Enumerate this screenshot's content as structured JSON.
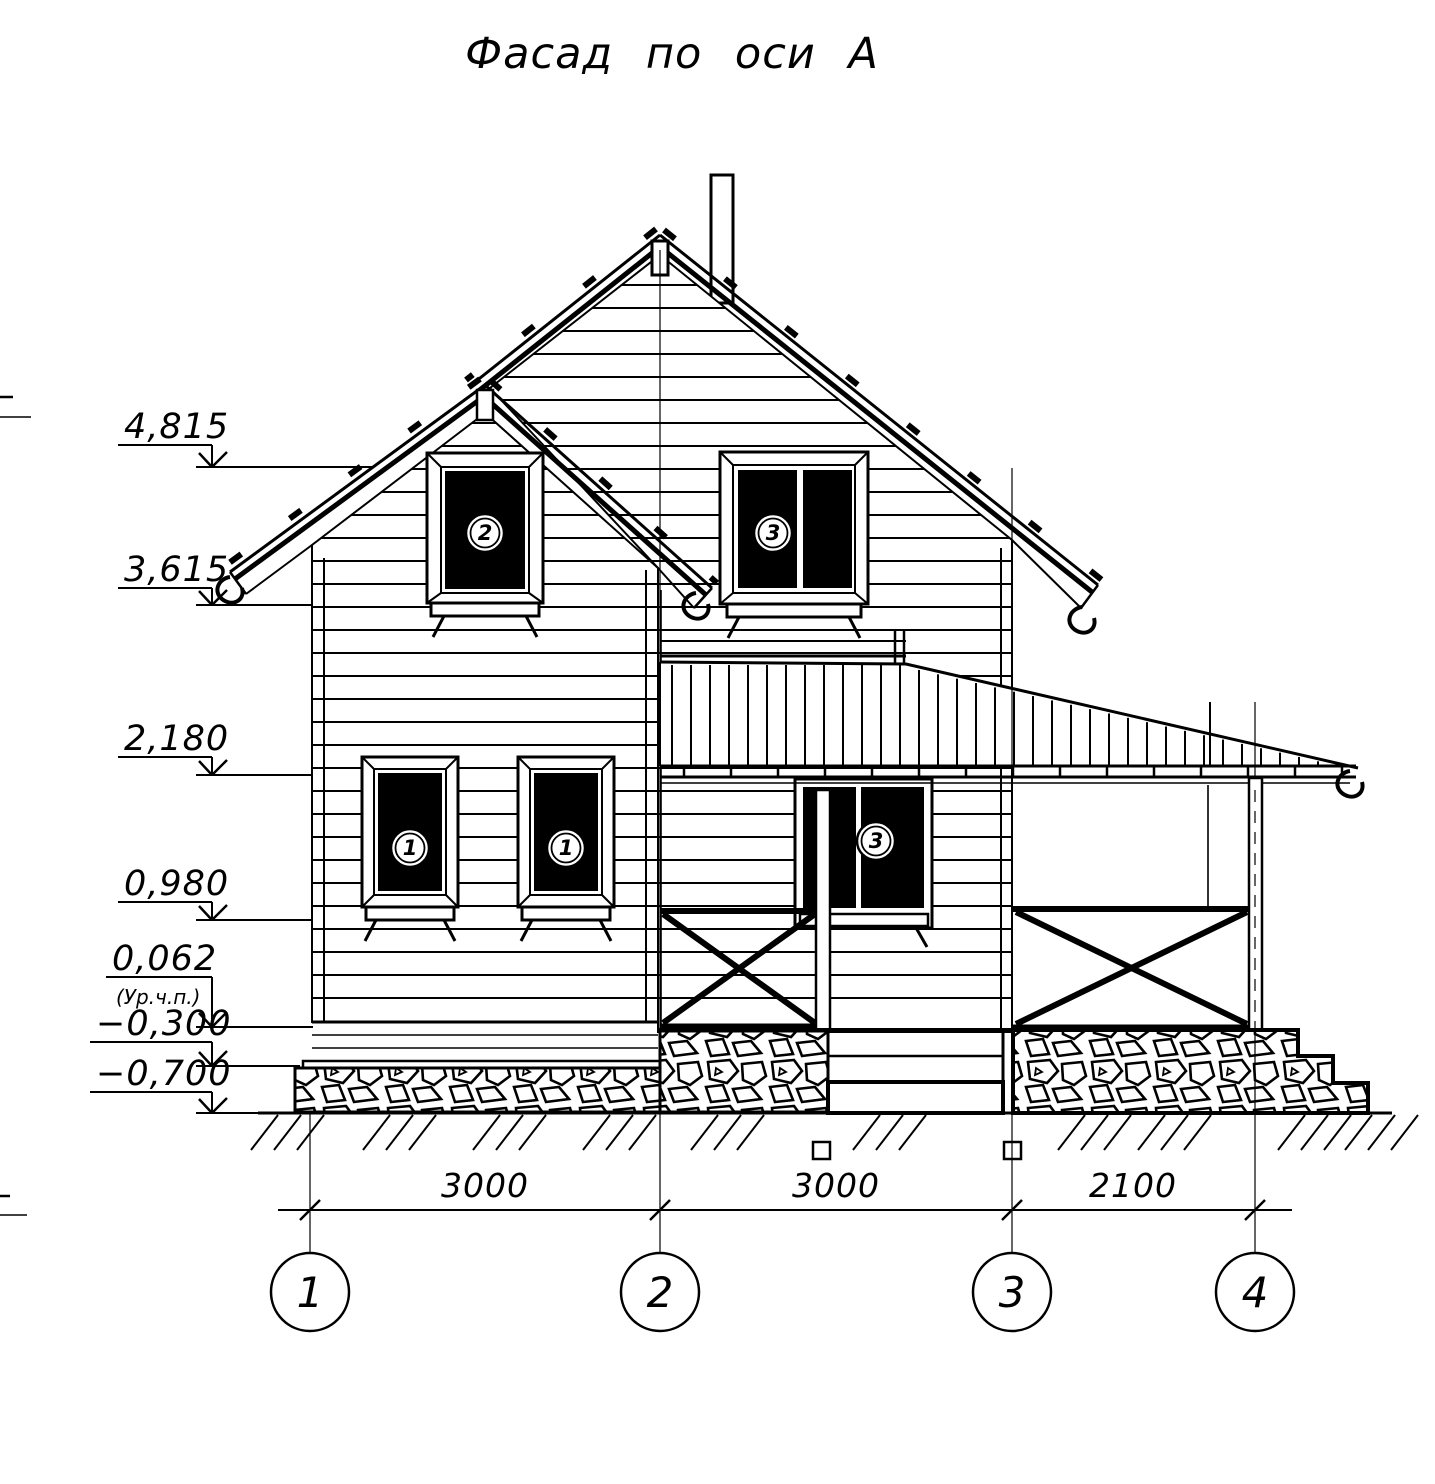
{
  "title": "Фасад по оси А",
  "levels": [
    {
      "value": "4,815"
    },
    {
      "value": "3,615"
    },
    {
      "value": "2,180"
    },
    {
      "value": "0,980"
    },
    {
      "value": "0,062",
      "note": "(Ур.ч.п.)"
    },
    {
      "value": "−0,300"
    },
    {
      "value": "−0,700"
    }
  ],
  "dimensions": [
    {
      "value": "3000"
    },
    {
      "value": "3000"
    },
    {
      "value": "2100"
    }
  ],
  "axes": [
    {
      "label": "1"
    },
    {
      "label": "2"
    },
    {
      "label": "3"
    },
    {
      "label": "4"
    }
  ],
  "window_marks": [
    {
      "label": "2"
    },
    {
      "label": "3"
    },
    {
      "label": "1"
    },
    {
      "label": "1"
    },
    {
      "label": "3"
    }
  ],
  "colors": {
    "line": "#000000",
    "background": "#ffffff"
  }
}
